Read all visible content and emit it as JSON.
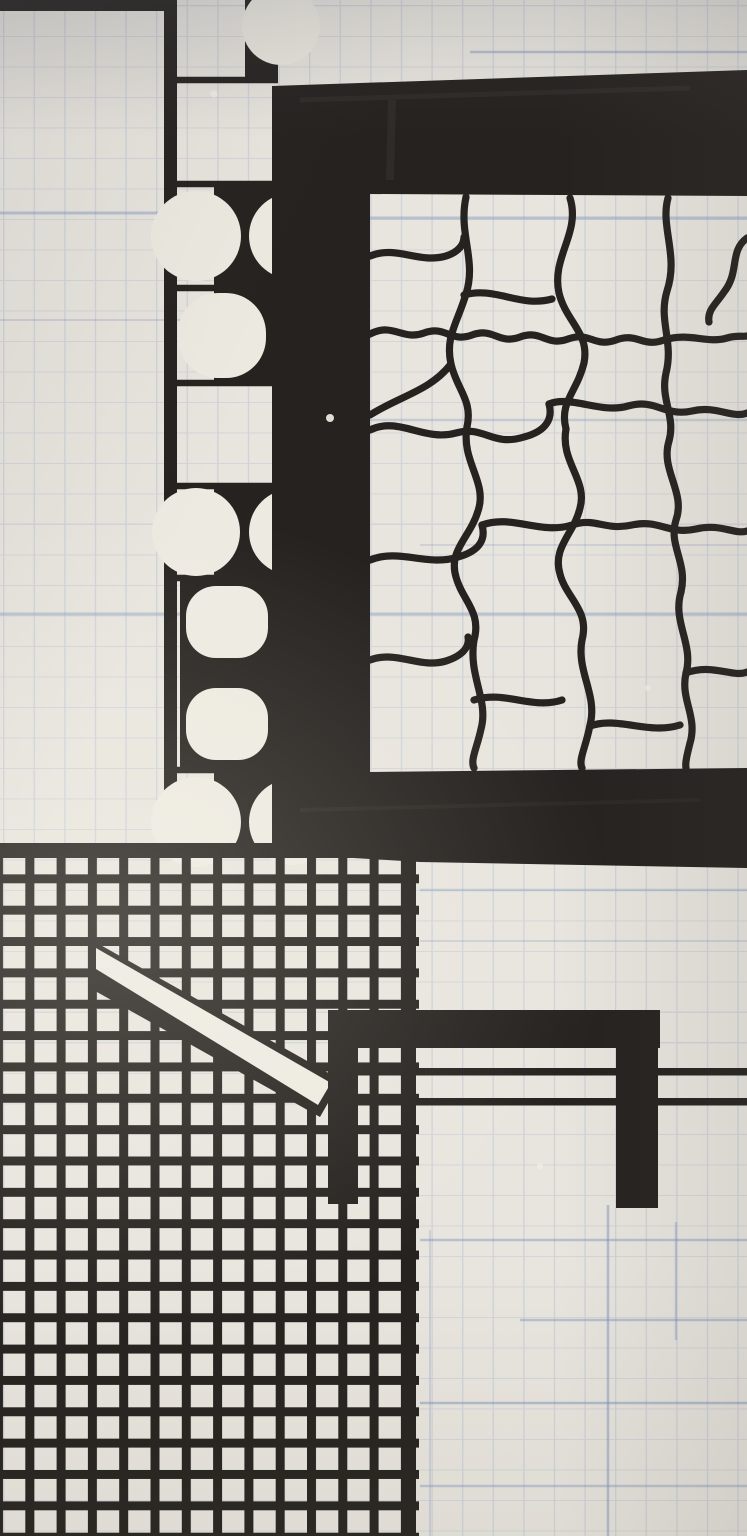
{
  "meta": {
    "kind": "photograph of a hand-painted black-and-white geometric mural on a wall pre-ruled with faint blue graph-paper grid",
    "visible_text": "",
    "grid_pitch_px": 30.6,
    "tile_pitch_px": 31.3
  },
  "palette": {
    "wall": "#e8e5de",
    "white_paint": "#edeae1",
    "wall_shadow": "#d9d8d6",
    "ink": "#25221f",
    "ink_soft": "#3a362f",
    "blue_strong": "#7e93bc",
    "blue_faint": "#9fb0cd"
  },
  "elements": {
    "ornament_strip": "vertical strip of cells with semicircle / hourglass / capsule motifs",
    "black_frame": "thick black square frame open to the right edge",
    "crackle": "organic crackle network of wavy black lines inside the frame",
    "tile_grid": "dense hand-painted black tile grid, bottom left",
    "diagonal_bar": "white diagonal bar outlined in black crossing the tile grid",
    "table_shape": "black pi-shaped table figure with two legs",
    "extended_lines": "two thin black horizontal lines running to the right edge"
  }
}
